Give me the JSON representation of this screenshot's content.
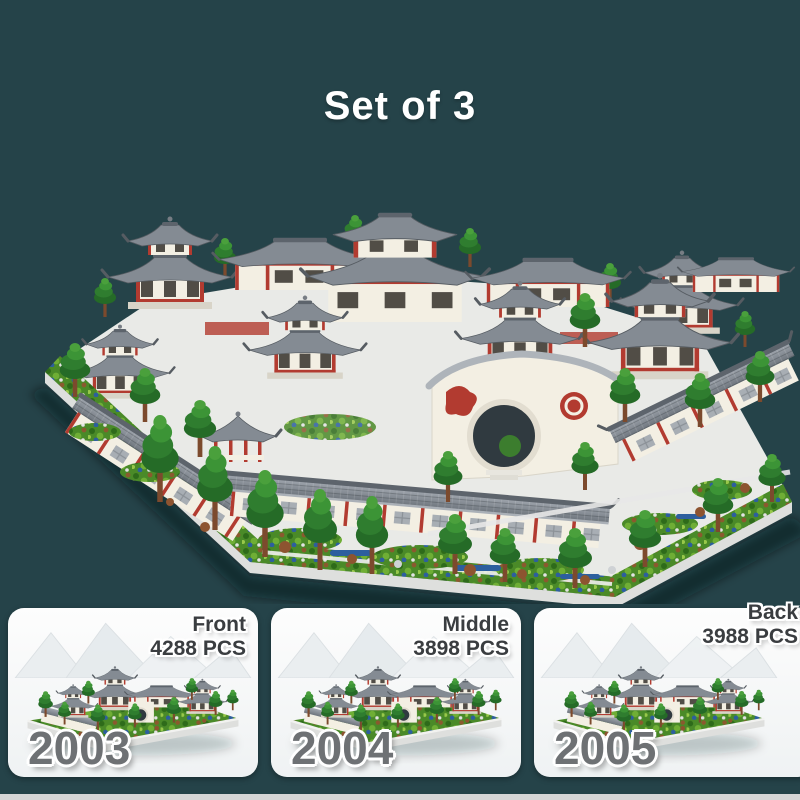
{
  "title": "Set of 3",
  "cards": [
    {
      "position": "Front",
      "pieces": "4288 PCS",
      "model_number": "2003"
    },
    {
      "position": "Middle",
      "pieces": "3898 PCS",
      "model_number": "2004"
    },
    {
      "position": "Back",
      "pieces": "3988 PCS",
      "model_number": "2005"
    }
  ],
  "colors": {
    "background": "#254349",
    "card-bg": "#fdfdfd",
    "card-bg-2": "#eff2f3",
    "title": "#ffffff",
    "label": "#3a3d40",
    "number": "#6e7174",
    "strip": "#d6d6d6",
    "roof": "#848b93",
    "roof-dark": "#5d646c",
    "roof-light": "#aab0b7",
    "wall": "#f3efe3",
    "red": "#b23b30",
    "tree": "#2f7d2f",
    "tree-light": "#4aa03c",
    "trunk": "#7c4a2d",
    "plate": "#e9eae7",
    "plate-side": "#dedfdd",
    "garden": "#4a8a28",
    "water": "#2d5f9e",
    "rock": "#8d5430"
  }
}
